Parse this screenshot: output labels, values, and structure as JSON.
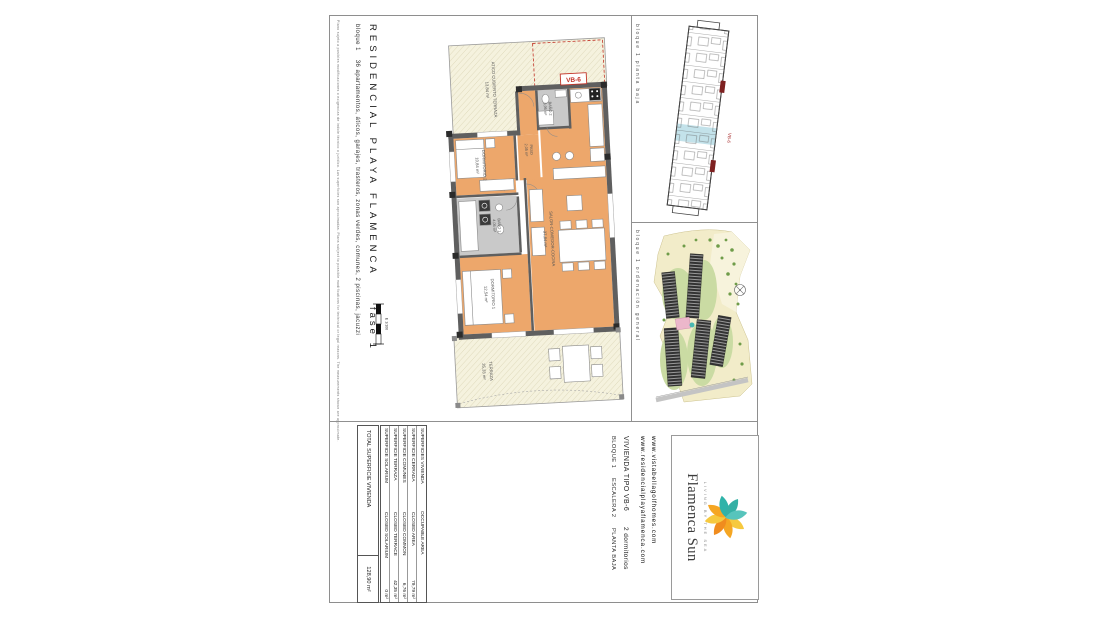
{
  "sheet": {
    "title": "RESIDENCIAL PLAYA FLAMENCA",
    "phase": "fase 1",
    "subtitle": "bloque 1    36 apartamentos, áticos, garajes, trasteros, zonas verdes, comunes, 2 piscinas, jacuzzi",
    "disclaimer": "Plano sujeto a posibles modificaciones o exigencias de índole técnico o jurídico. Las superficies son aproximadas. Plans subject to possible modifications for technical or legal reasons. The measurements shown are approximate.",
    "scale_label": "E 1/100"
  },
  "floor_plan": {
    "unit_label": "VB-6",
    "rooms": [
      {
        "name": "ATICO CUBIERTO TERRAZA",
        "area": "13,84 m²"
      },
      {
        "name": "DORMITORIO 2",
        "area": "10,84 m²"
      },
      {
        "name": "BAÑO 2",
        "area": "3,95 m²"
      },
      {
        "name": "PASO",
        "area": "2,05 m²"
      },
      {
        "name": "BAÑO 1",
        "area": "4,05 m²"
      },
      {
        "name": "DORMITORIO 1",
        "area": "12,54 m²"
      },
      {
        "name": "SALON-COMEDOR-COCINA",
        "area": "37,84 m²"
      },
      {
        "name": "TERRAZA",
        "area": "35,33 m²"
      }
    ]
  },
  "panels": {
    "block_plan_label": "bloque 1 planta baja",
    "block_plan_unit": "VB-6",
    "site_plan_label": "bloque 1 ordenación general"
  },
  "surfaces_table": {
    "header_es": "SUPERFICIES VIVIENDA",
    "header_en": "OCCUPABLE AREA",
    "rows": [
      {
        "es": "SUPERFICIE CERRADA",
        "en": "CLOSED AREA",
        "value": "79,79 m²"
      },
      {
        "es": "SUPERFICIE COMUNES",
        "en": "CLOSED COMMON",
        "value": "6,76 m²"
      },
      {
        "es": "SUPERFICIE TERRAZA",
        "en": "CLOSED TERRACE",
        "value": "42,35 m²"
      },
      {
        "es": "SUPERFICIE SOLARIUM",
        "en": "CLOSED SOLARIUM",
        "value": "0 m²"
      }
    ],
    "total_label": "TOTAL SUPERFICIE VIVIENDA",
    "total_value": "128,90 m²"
  },
  "unit_info": {
    "type": "VIVIENDA TIPO VB-6",
    "bedrooms": "2 dormitorios",
    "block": "BLOQUE 1",
    "stair": "ESCALERA 2",
    "floor": "PLANTA BAJA"
  },
  "websites": {
    "first": "www.vistabellagolfhomes.com",
    "second": "www.residencialplayaflamenca.com"
  },
  "logo": {
    "name": "Flamenca Sun",
    "tagline": "LIVING BY THE SEA",
    "colors": {
      "teal": "#2FB3A9",
      "orange": "#F08C1E",
      "yellow": "#F6C93F",
      "red_accent": "#C23428"
    }
  }
}
